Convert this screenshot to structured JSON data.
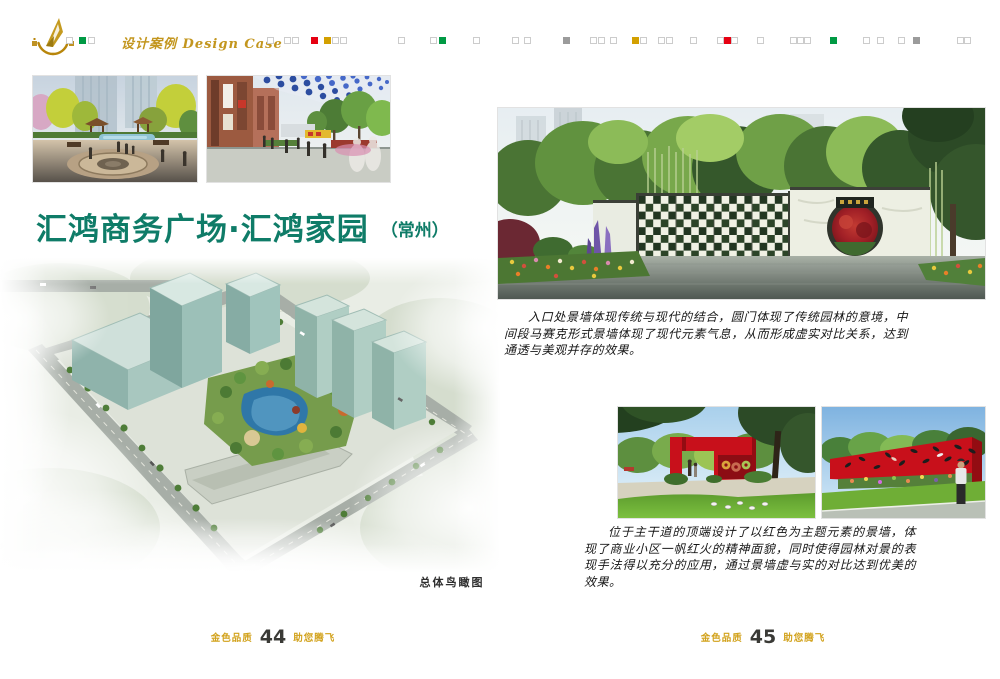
{
  "header": {
    "logo": "golden-sail-emblem",
    "section_label_zh": "设计案例",
    "section_label_en": "Design Case",
    "square_colors": {
      "o": "#ffffff",
      "g": "#009a44",
      "r": "#e60012",
      "y": "#d3a000",
      "a": "#9b9b9b"
    },
    "squares": [
      {
        "x": 66,
        "f": "o"
      },
      {
        "x": 79,
        "f": "g"
      },
      {
        "x": 88,
        "f": "o"
      },
      {
        "x": 267,
        "f": "o"
      },
      {
        "x": 284,
        "f": "o"
      },
      {
        "x": 292,
        "f": "o"
      },
      {
        "x": 311,
        "f": "r"
      },
      {
        "x": 324,
        "f": "y"
      },
      {
        "x": 332,
        "f": "o"
      },
      {
        "x": 340,
        "f": "o"
      },
      {
        "x": 398,
        "f": "o"
      },
      {
        "x": 430,
        "f": "o"
      },
      {
        "x": 439,
        "f": "g"
      },
      {
        "x": 473,
        "f": "o"
      },
      {
        "x": 512,
        "f": "o"
      },
      {
        "x": 524,
        "f": "o"
      },
      {
        "x": 563,
        "f": "a"
      },
      {
        "x": 590,
        "f": "o"
      },
      {
        "x": 598,
        "f": "o"
      },
      {
        "x": 610,
        "f": "o"
      },
      {
        "x": 632,
        "f": "y"
      },
      {
        "x": 640,
        "f": "o"
      },
      {
        "x": 658,
        "f": "o"
      },
      {
        "x": 666,
        "f": "o"
      },
      {
        "x": 690,
        "f": "o"
      },
      {
        "x": 717,
        "f": "o"
      },
      {
        "x": 724,
        "f": "r"
      },
      {
        "x": 731,
        "f": "o"
      },
      {
        "x": 757,
        "f": "o"
      },
      {
        "x": 790,
        "f": "o"
      },
      {
        "x": 797,
        "f": "o"
      },
      {
        "x": 804,
        "f": "o"
      },
      {
        "x": 830,
        "f": "g"
      },
      {
        "x": 863,
        "f": "o"
      },
      {
        "x": 877,
        "f": "o"
      },
      {
        "x": 898,
        "f": "o"
      },
      {
        "x": 913,
        "f": "a"
      },
      {
        "x": 957,
        "f": "o"
      },
      {
        "x": 964,
        "f": "o"
      }
    ]
  },
  "left_page": {
    "title": "汇鸿商务广场·汇鸿家园",
    "location": "（常州）",
    "aerial_caption": "总体鸟瞰图",
    "figures": {
      "top_left": "plaza-pond-rendering",
      "top_right": "commercial-street-rendering",
      "main": "overall-aerial-view-rendering"
    },
    "footer": {
      "brand": "金色品质",
      "page": "44",
      "slogan": "助您腾飞"
    }
  },
  "right_page": {
    "figures": {
      "main": "entrance-mosaic-wall-rendering",
      "small_left": "red-gate-plaza-rendering",
      "small_right": "red-feature-wall-rendering"
    },
    "para_entrance": "入口处景墙体现传统与现代的结合，圆门体现了传统园林的意境，中间段马赛克形式景墙体现了现代元素气息，从而形成虚实对比关系，达到通透与美观并存的效果。",
    "para_red_wall": "位于主干道的顶端设计了以红色为主题元素的景墙，体现了商业小区一帆红火的精神面貌，同时使得园林对景的表现手法得以充分的应用，通过景墙虚与实的对比达到优美的效果。",
    "footer": {
      "brand": "金色品质",
      "page": "45",
      "slogan": "助您腾飞"
    }
  },
  "theme": {
    "gold": "#c3961e",
    "title_green": "#0f7c68",
    "ink": "#1c1c1c"
  }
}
